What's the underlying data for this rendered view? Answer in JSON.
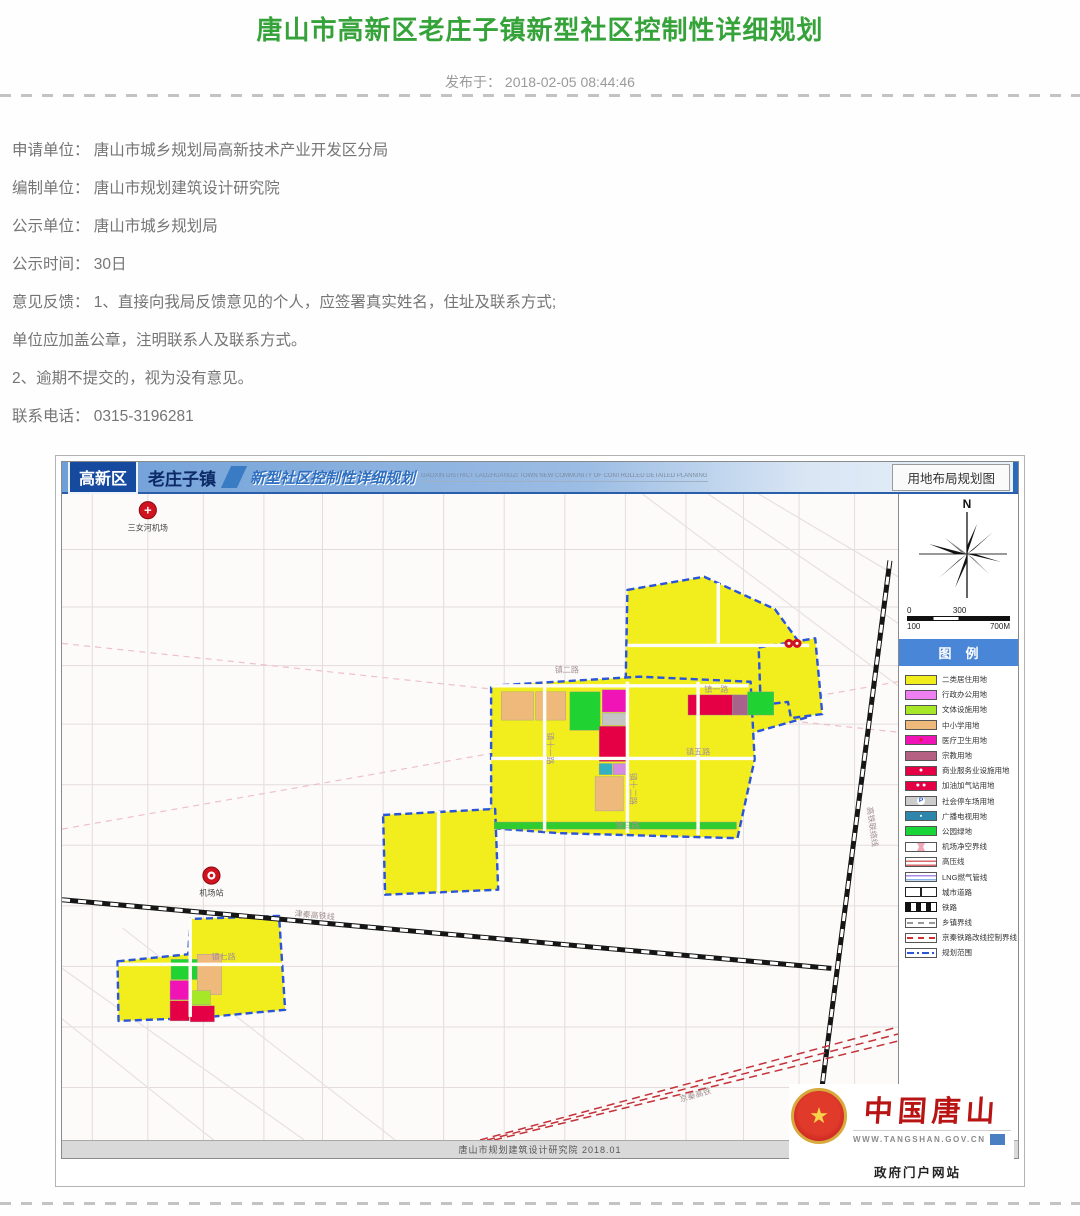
{
  "page": {
    "title": "唐山市高新区老庄子镇新型社区控制性详细规划",
    "published": "发布于： 2018-02-05 08:44:46"
  },
  "body": {
    "lines": [
      "申请单位： 唐山市城乡规划局高新技术产业开发区分局",
      "编制单位： 唐山市规划建筑设计研究院",
      "公示单位： 唐山市城乡规划局",
      "公示时间： 30日",
      "意见反馈： 1、直接向我局反馈意见的个人，应签署真实姓名，住址及联系方式;",
      "单位应加盖公章，注明联系人及联系方式。",
      "2、逾期不提交的，视为没有意见。",
      "联系电话： 0315-3196281"
    ]
  },
  "figure": {
    "header": {
      "district": "高新区",
      "town": "老庄子镇",
      "plan_title": "新型社区控制性详细规划",
      "plan_title_en": "GAOXIN DISTRICT LAOZHUANGZI TOWN NEW COMMUNITY OF CONTROLLED DETAILED PLANNING",
      "map_type": "用地布局规划图"
    },
    "compass": {
      "label": "N"
    },
    "scalebar": {
      "top_left": "0",
      "top_mid": "300",
      "bottom_left": "100",
      "bottom_right": "700M"
    },
    "legend": {
      "title": "图例",
      "items": [
        {
          "label": "二类居住用地",
          "type": "solid",
          "color": "#f2ee1e"
        },
        {
          "label": "行政办公用地",
          "type": "solid",
          "color": "#ee7ff0"
        },
        {
          "label": "文体设施用地",
          "type": "solid",
          "color": "#a6e828"
        },
        {
          "label": "中小学用地",
          "type": "solid",
          "color": "#efb97c"
        },
        {
          "label": "医疗卫生用地",
          "type": "solid",
          "color": "#f013b6",
          "glyph": "+",
          "glyph_color": "#e01010"
        },
        {
          "label": "宗教用地",
          "type": "solid",
          "color": "#b56183"
        },
        {
          "label": "商业服务业设施用地",
          "type": "solid",
          "color": "#e50045",
          "glyph": "●",
          "glyph_color": "#ffffff"
        },
        {
          "label": "加油加气站用地",
          "type": "solid",
          "color": "#e50045",
          "glyph": "● ●",
          "glyph_color": "#ffffff"
        },
        {
          "label": "社会停车场用地",
          "type": "solid",
          "color": "#cccccc",
          "glyph": "P",
          "glyph_color": "#1a4ecc",
          "circle": true
        },
        {
          "label": "广播电视用地",
          "type": "solid",
          "color": "#2f86ac",
          "glyph": "▪",
          "glyph_color": "#ffffff"
        },
        {
          "label": "公园绿地",
          "type": "solid",
          "color": "#19d537"
        },
        {
          "label": "机场净空界线",
          "type": "cross",
          "color": "#f0a8b8"
        },
        {
          "label": "高压线",
          "type": "stripes",
          "color": "#d46a6a"
        },
        {
          "label": "LNG燃气管线",
          "type": "lng",
          "color": "#a88ae8",
          "color2": "#8ab4e8"
        },
        {
          "label": "城市道路",
          "type": "road",
          "color": "#333333"
        },
        {
          "label": "铁路",
          "type": "rail",
          "color": "#111111"
        },
        {
          "label": "乡镇界线",
          "type": "dash",
          "color": "#999999"
        },
        {
          "label": "京秦铁路改线控制界线",
          "type": "dash",
          "color": "#d03030"
        },
        {
          "label": "规划范围",
          "type": "dashdot",
          "color": "#2b55d8"
        }
      ]
    },
    "footer": {
      "credit": "唐山市规划建筑设计研究院  2018.01"
    },
    "logo": {
      "brand": "中国唐山",
      "url": "WWW.TANGSHAN.GOV.CN",
      "site": "政府门户网站",
      "star": "★"
    }
  },
  "map": {
    "bg": "#fcfbfa",
    "cluster_fill": "#f2ee1e",
    "cluster_stroke": "#2b55d8",
    "grid": {
      "v": [
        30,
        85,
        140,
        200,
        258,
        318,
        378,
        438,
        498,
        558,
        618,
        675,
        730,
        785
      ],
      "h": [
        55,
        112,
        170,
        228,
        288,
        348,
        408,
        468,
        528,
        588
      ],
      "diag": [
        [
          640,
          0,
          828,
          128
        ],
        [
          690,
          0,
          828,
          82
        ],
        [
          575,
          0,
          828,
          190
        ],
        [
          0,
          470,
          240,
          640
        ],
        [
          60,
          430,
          330,
          640
        ],
        [
          0,
          520,
          150,
          640
        ]
      ]
    },
    "pink_lines": [
      [
        0,
        148,
        828,
        236
      ],
      [
        0,
        332,
        828,
        186
      ]
    ],
    "clusters": [
      {
        "points": "560,95 636,82 706,114 744,166 739,221 686,236 600,231 558,202"
      },
      {
        "points": "690,152 746,143 753,218 722,222 719,206 692,209"
      },
      {
        "points": "425,190 572,181 682,186 686,263 669,341 492,336 425,331"
      },
      {
        "points": "318,318 429,312 432,392 320,397"
      },
      {
        "points": "55,463 125,456 127,421 215,418 221,511 136,519 56,522"
      }
    ],
    "parcels": [
      [
        435,
        196,
        32,
        28,
        "#efb97c"
      ],
      [
        469,
        196,
        30,
        28,
        "#efb97c"
      ],
      [
        503,
        196,
        30,
        38,
        "#21d332"
      ],
      [
        535,
        194,
        24,
        22,
        "#f013b6"
      ],
      [
        535,
        217,
        24,
        12,
        "#c4c4c4"
      ],
      [
        532,
        230,
        27,
        35,
        "#e50045"
      ],
      [
        532,
        267,
        13,
        11,
        "#35b0c0"
      ],
      [
        546,
        267,
        13,
        11,
        "#d58ae0"
      ],
      [
        528,
        280,
        28,
        34,
        "#efb97c"
      ],
      [
        620,
        199,
        44,
        20,
        "#e50045"
      ],
      [
        664,
        199,
        15,
        20,
        "#a8638c"
      ],
      [
        679,
        196,
        26,
        23,
        "#21d332"
      ],
      [
        428,
        325,
        240,
        7,
        "#2ecc2e"
      ],
      [
        108,
        461,
        26,
        20,
        "#21d332"
      ],
      [
        134,
        456,
        24,
        40,
        "#efb97c"
      ],
      [
        107,
        482,
        19,
        19,
        "#f013b6"
      ],
      [
        107,
        502,
        19,
        20,
        "#e50045"
      ],
      [
        127,
        492,
        20,
        14,
        "#a6e828"
      ],
      [
        127,
        507,
        24,
        16,
        "#e50045"
      ]
    ],
    "roads": [
      [
        425,
        262,
        685,
        262
      ],
      [
        478,
        186,
        478,
        334
      ],
      [
        560,
        186,
        560,
        336
      ],
      [
        630,
        186,
        630,
        338
      ],
      [
        560,
        150,
        740,
        150
      ],
      [
        650,
        88,
        650,
        148
      ],
      [
        56,
        466,
        218,
        466
      ],
      [
        127,
        420,
        127,
        518
      ],
      [
        373,
        314,
        373,
        394
      ],
      [
        425,
        190,
        680,
        190
      ]
    ],
    "railways": [
      [
        820,
        66,
        746,
        640
      ],
      [
        0,
        402,
        762,
        470
      ]
    ],
    "red_lines": [
      [
        414,
        640,
        828,
        528
      ],
      [
        421,
        640,
        828,
        535
      ],
      [
        428,
        640,
        828,
        542
      ]
    ],
    "markers": [
      {
        "x": 85,
        "y": 16,
        "kind": "cross",
        "label": "三女河机场"
      },
      {
        "x": 148,
        "y": 378,
        "kind": "ring",
        "label": "机场站"
      },
      {
        "x": 724,
        "y": 148,
        "kind": "double",
        "label": ""
      }
    ],
    "road_labels": [
      {
        "x": 500,
        "y": 177,
        "t": "镇二路",
        "r": 0
      },
      {
        "x": 648,
        "y": 196,
        "t": "镇一路",
        "r": 0
      },
      {
        "x": 630,
        "y": 258,
        "t": "镇五路",
        "r": 0
      },
      {
        "x": 560,
        "y": 331,
        "t": "镇三路",
        "r": 0
      },
      {
        "x": 160,
        "y": 461,
        "t": "镇七路",
        "r": 0
      },
      {
        "x": 481,
        "y": 252,
        "t": "镇十一路",
        "r": 90
      },
      {
        "x": 563,
        "y": 292,
        "t": "镇十二路",
        "r": 90
      },
      {
        "x": 250,
        "y": 420,
        "t": "津秦高铁线",
        "r": 5
      },
      {
        "x": 628,
        "y": 598,
        "t": "京秦高铁",
        "r": -16
      },
      {
        "x": 800,
        "y": 330,
        "t": "高铁联络线",
        "r": 82
      }
    ]
  }
}
